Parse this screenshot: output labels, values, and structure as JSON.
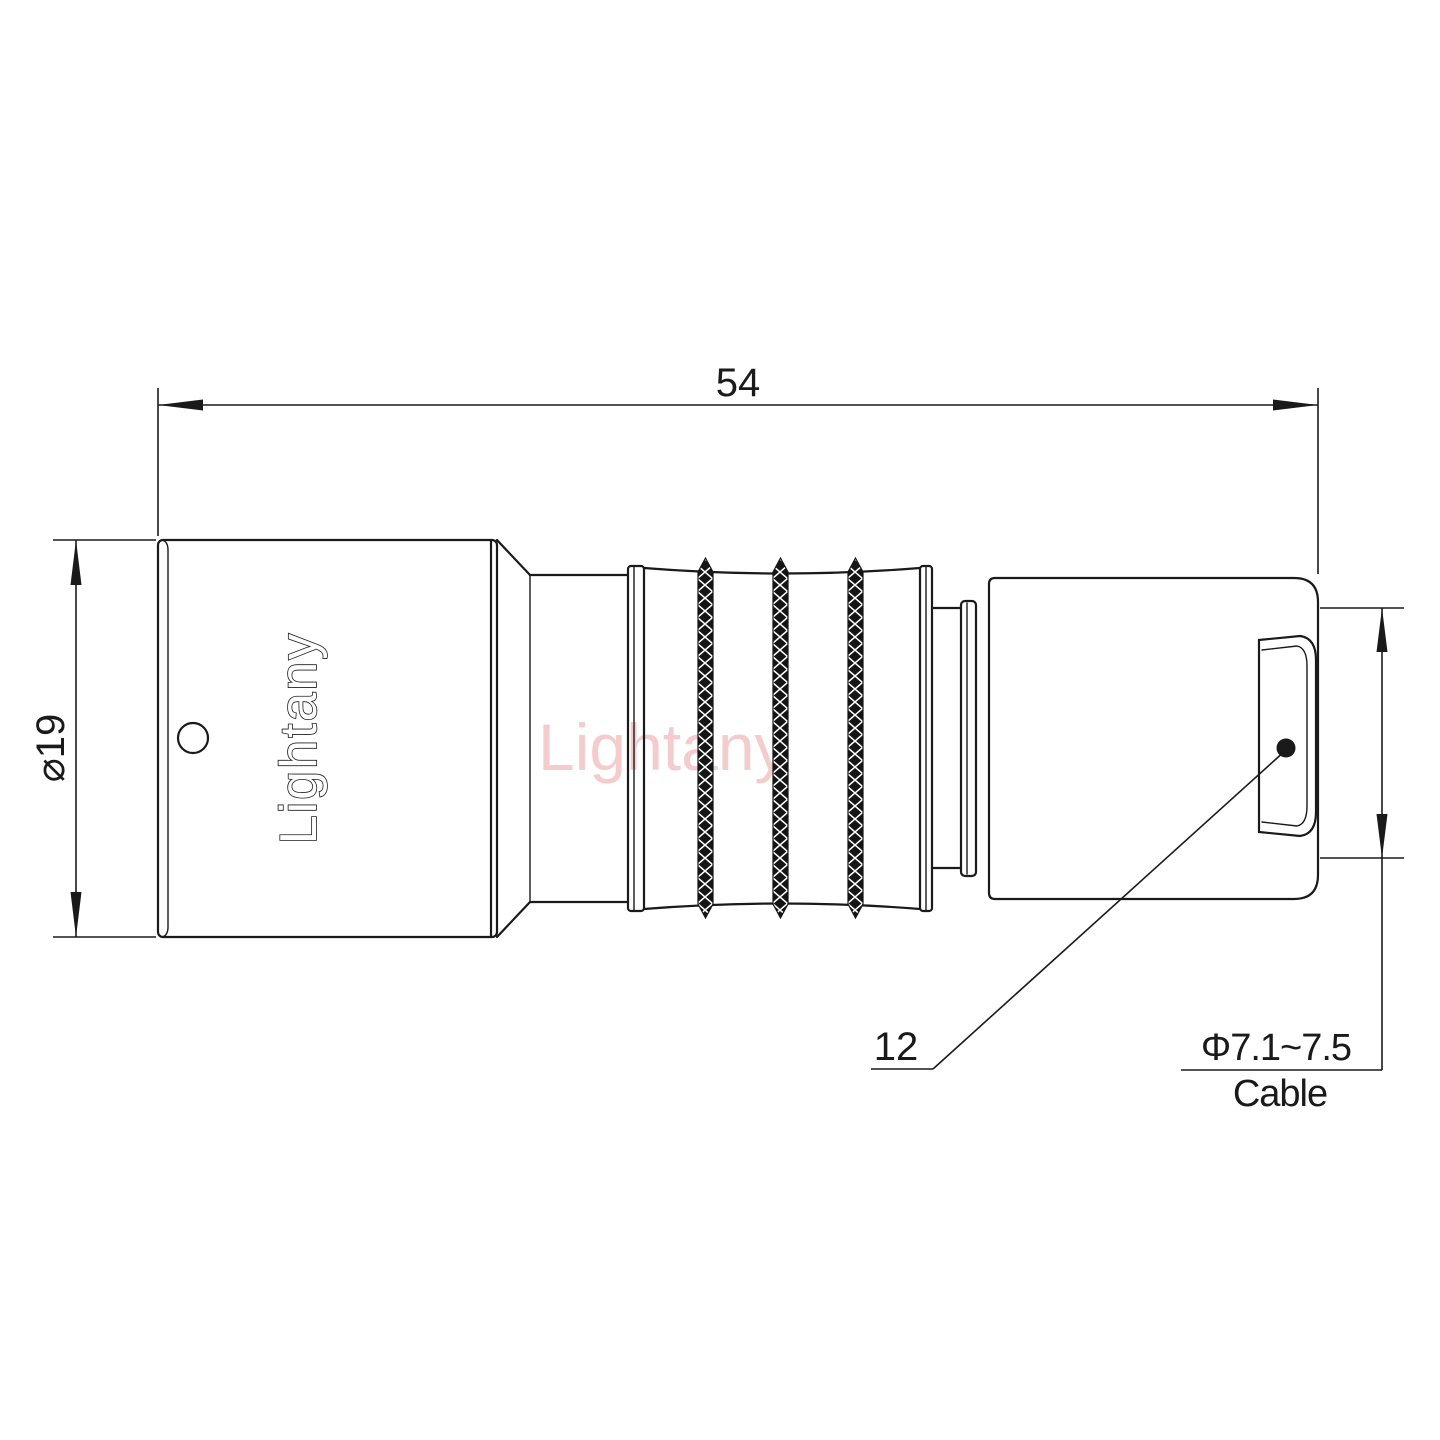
{
  "drawing": {
    "title": "connector-technical-drawing",
    "background_color": "#ffffff",
    "line_color": "#1a1a1a",
    "watermark_color": "#e88f8f",
    "dim_length": "54",
    "dim_diameter": "⌀19",
    "dim_rear": "12",
    "cable_diameter": "Φ7.1~7.5",
    "cable_label": "Cable",
    "brand": "Lightany",
    "watermark": "Lightany"
  }
}
